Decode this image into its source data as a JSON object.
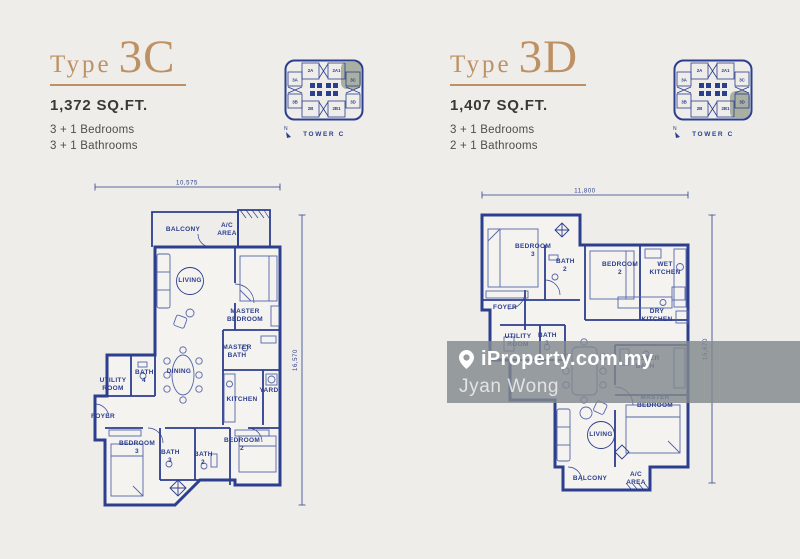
{
  "colors": {
    "navy": "#2c3e8e",
    "gold": "#bd9164",
    "highlight": "#a9b0a1",
    "background": "#eeede9",
    "furniture": "#5565a8"
  },
  "panels": [
    {
      "type_label": "Type",
      "type_code": "3C",
      "area": "1,372 SQ.FT.",
      "bedrooms": "3 + 1 Bedrooms",
      "bathrooms": "3 + 1 Bathrooms"
    },
    {
      "type_label": "Type",
      "type_code": "3D",
      "area": "1,407 SQ.FT.",
      "bedrooms": "3 + 1 Bedrooms",
      "bathrooms": "2 + 1 Bathrooms"
    }
  ],
  "tower": {
    "label": "TOWER C",
    "compass": "N",
    "units": [
      "2A",
      "2A1",
      "3A",
      "3C",
      "3B",
      "3D",
      "2B",
      "2B1"
    ]
  },
  "plans": [
    {
      "width_dim": "10,575",
      "height_dim": "16,570",
      "rooms": [
        "BALCONY",
        "A/C AREA",
        "LIVING",
        "MASTER BEDROOM",
        "MASTER BATH",
        "DINING",
        "UTILITY ROOM",
        "BATH 4",
        "FOYER",
        "KITCHEN",
        "YARD",
        "BEDROOM 3",
        "BATH 3",
        "BATH 2",
        "BEDROOM 2"
      ]
    },
    {
      "width_dim": "11,800",
      "height_dim": "15,670",
      "rooms": [
        "BEDROOM 3",
        "BATH 2",
        "BEDROOM 2",
        "WET KITCHEN",
        "FOYER",
        "DRY KITCHEN",
        "UTILITY ROOM",
        "BATH 3",
        "MASTER BATH",
        "MASTER BEDROOM",
        "LIVING",
        "BALCONY",
        "A/C AREA"
      ]
    }
  ],
  "watermark": {
    "brand": "iProperty.com.my",
    "user": "Jyan Wong"
  }
}
